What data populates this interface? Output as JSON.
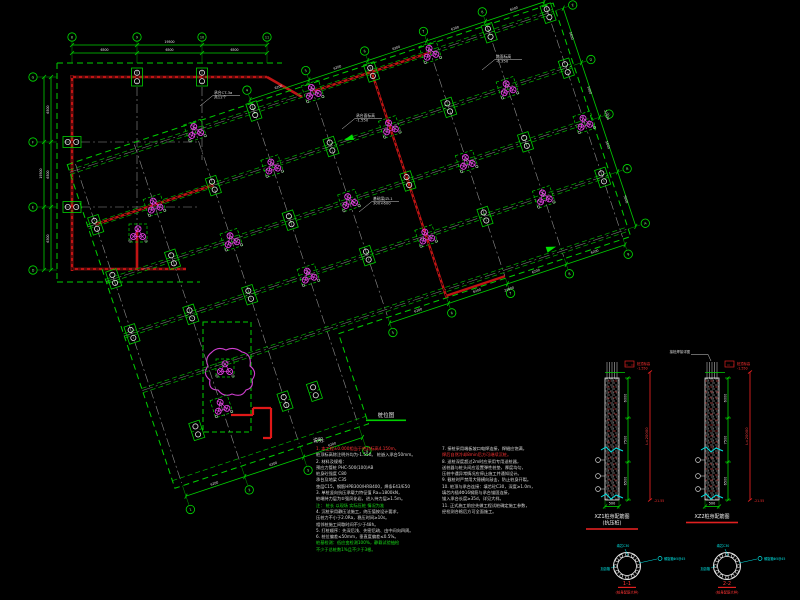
{
  "app": {
    "background": "#000000"
  },
  "colors": {
    "green": "#00d000",
    "bright_green": "#19e019",
    "red": "#e01818",
    "magenta": "#e040e0",
    "gray": "#8f8f8f",
    "white": "#e8e8e8",
    "cyan": "#00e5e5"
  },
  "plan": {
    "title": "桩位图",
    "ortho": {
      "top_bubbles": [
        "8",
        "9",
        "10",
        "11"
      ],
      "top_dims": [
        "6500",
        "6500",
        "6500"
      ],
      "top_total": "19500",
      "left_bubbles": [
        "G",
        "F",
        "E",
        "D"
      ],
      "left_dims": [
        "6500",
        "6500",
        "6300"
      ],
      "left_total": "19300"
    },
    "rot": {
      "bottom_bubbles": [
        "5",
        "6",
        "7",
        "8",
        "9"
      ],
      "wing_bubbles": [
        "1",
        "2",
        "3",
        "4"
      ],
      "top_bubbles": [
        "4",
        "5",
        "6",
        "7",
        "8",
        "9"
      ],
      "right_bubbles": [
        "A",
        "B",
        "C",
        "D",
        "E"
      ],
      "bottom_dims": [
        "6200",
        "6200",
        "6200",
        "6200"
      ],
      "wing_dims": [
        "6200",
        "6200",
        "6200"
      ],
      "top_dims": [
        "6200",
        "6200",
        "6200",
        "6200",
        "6200"
      ],
      "right_dims": [
        "5600",
        "5600",
        "5600",
        "5600"
      ],
      "bottom_total": "24800",
      "right_total": "22400"
    },
    "piles": {
      "tri": [
        [
          62,
          -172
        ],
        [
          124,
          -115
        ],
        [
          186,
          -172
        ],
        [
          186,
          -57
        ],
        [
          248,
          -115
        ],
        [
          310,
          -172
        ],
        [
          310,
          -57
        ],
        [
          372,
          -115
        ],
        [
          434,
          -172
        ],
        [
          434,
          -57
        ],
        [
          124,
          -230
        ],
        [
          248,
          -230
        ],
        [
          372,
          -230
        ],
        [
          496,
          -115
        ],
        [
          62,
          40
        ]
      ],
      "duo": [
        [
          0,
          -57
        ],
        [
          0,
          -115
        ],
        [
          0,
          -172
        ],
        [
          62,
          -57
        ],
        [
          62,
          -115
        ],
        [
          124,
          -57
        ],
        [
          124,
          -172
        ],
        [
          186,
          -115
        ],
        [
          248,
          -57
        ],
        [
          248,
          -172
        ],
        [
          310,
          -115
        ],
        [
          310,
          -230
        ],
        [
          372,
          -57
        ],
        [
          372,
          -172
        ],
        [
          434,
          -115
        ],
        [
          434,
          -230
        ],
        [
          496,
          -57
        ],
        [
          496,
          -172
        ],
        [
          186,
          -230
        ],
        [
          496,
          -230
        ],
        [
          31,
          55
        ],
        [
          124,
          55
        ],
        [
          155,
          55
        ]
      ],
      "ortho_duo": [
        {
          "x": 137,
          "y": 77,
          "rot": 0
        },
        {
          "x": 202,
          "y": 77,
          "rot": 0
        },
        {
          "x": 72,
          "y": 142,
          "rot": 90
        },
        {
          "x": 72,
          "y": 207,
          "rot": 90
        }
      ],
      "ortho_tri": [
        {
          "x": 138,
          "y": 233
        }
      ]
    },
    "leaders": [
      {
        "x": 356,
        "y": 117,
        "lines": [
          "承台面标高",
          "-1.550"
        ]
      },
      {
        "x": 496,
        "y": 58,
        "lines": [
          "路面标高",
          "-0.350"
        ]
      },
      {
        "x": 214,
        "y": 94,
        "lines": [
          "承台CT-3a",
          "共12个"
        ]
      },
      {
        "x": 373,
        "y": 200,
        "lines": [
          "基础梁JZL1",
          "300×600"
        ]
      }
    ]
  },
  "details": {
    "items": [
      {
        "cx": 612,
        "dims": [
          "6000",
          "7500",
          "6500"
        ],
        "total": "L=20000",
        "width": "500",
        "top_note": [
          "桩顶标高",
          "-1.550"
        ],
        "bottom_mark": "-21.55",
        "title": [
          "XZ1桩身配筋图",
          "(抗压桩)"
        ]
      },
      {
        "cx": 712,
        "dims": [
          "6000",
          "7500",
          "6500"
        ],
        "total": "L=20000",
        "width": "500",
        "top_note": [
          "桩顶标高",
          "-1.550"
        ],
        "bottom_mark": "-21.55",
        "title": [
          "XZ2桩身配筋图"
        ],
        "top_leader": "接桩焊接详图"
      }
    ]
  },
  "sections": {
    "items": [
      {
        "cx": 627,
        "label": "1-1",
        "sub": "(桩身配筋大样)",
        "left": "加劲箍",
        "right": "螺旋箍Φ5@45",
        "top": "填芯C30"
      },
      {
        "cx": 727,
        "label": "2-2",
        "sub": "(桩身配筋大样)",
        "left": "加劲箍",
        "right": "螺旋箍Φ5@45",
        "top": "填芯C30"
      }
    ]
  },
  "notes": {
    "title": "说明:",
    "left": [
      {
        "t": "1. 本工程±0.000相当于绝对标高4.150m，",
        "c": "r"
      },
      {
        "t": "   桩顶标高除注明外均为-1.550。 桩嵌入承台50mm。",
        "c": "w"
      },
      {
        "t": "2. 材料及规格：",
        "c": "w"
      },
      {
        "t": "   预应力管桩  PHC-500(100)AB",
        "c": "w"
      },
      {
        "t": "   桩身砼强度  C80",
        "c": "w"
      },
      {
        "t": "   承台及地梁  C35",
        "c": "w"
      },
      {
        "t": "   垫层C15，钢筋HPB300/HRB400，焊条E43/E50",
        "c": "w"
      },
      {
        "t": "3. 单桩竖向抗压承载力特征值 Ra=1800kN，",
        "c": "w"
      },
      {
        "t": "   桩端持力层为⑤强风化岩，进入持力层≥1.5m。",
        "c": "w"
      },
      {
        "t": "   注： 桩长 以现场 实际压桩 情况为准",
        "c": "g"
      },
      {
        "t": "4. 沉桩采用静压法施工，终压值按设计要求，",
        "c": "w"
      },
      {
        "t": "   压桩力不小于2.0Ra，稳压时间≥10s。",
        "c": "w"
      },
      {
        "t": "   相邻桩施工间歇时间不少于48h。",
        "c": "w"
      },
      {
        "t": "5. 打桩顺序：先深后浅、先密后疏、由中间向四周。",
        "c": "w"
      },
      {
        "t": "6. 桩位偏差≤50mm，垂直度偏差≤0.5%。",
        "c": "w"
      },
      {
        "t": "   桩基检测：低应变检测100%，静载试验抽检",
        "c": "g"
      },
      {
        "t": "   不少于总桩数1%且不少于3根。",
        "c": "g"
      }
    ],
    "right": [
      {
        "t": "7. 接桩采用端板坡口电焊连接，焊缝应饱满，",
        "c": "w"
      },
      {
        "t": "   焊后自然冷却8min后方可继续沉桩。",
        "c": "r"
      },
      {
        "t": "8. 送桩深度超过2m时应采用专用送桩器，",
        "c": "w"
      },
      {
        "t": "   送桩器与桩头间应设置弹性桩垫，厚度均匀，",
        "c": "w"
      },
      {
        "t": "   压桩中遇异常情况应停止施工并通知设计。",
        "c": "w"
      },
      {
        "t": "9. 截桩时严禁用大锤横向敲击，防止桩身开裂。",
        "c": "w"
      },
      {
        "t": "10. 桩顶与承台连接：填芯砼C30，深度≥1.0m，",
        "c": "w"
      },
      {
        "t": "   填芯内插4Φ16钢筋与承台锚固连接，",
        "c": "w"
      },
      {
        "t": "   锚入承台长度≥35d，详见大样。",
        "c": "w"
      },
      {
        "t": "11. 正式施工前应先做工程试桩确定施工参数，",
        "c": "w"
      },
      {
        "t": "    经检测合格后方可全面施工。",
        "c": "w"
      }
    ]
  }
}
